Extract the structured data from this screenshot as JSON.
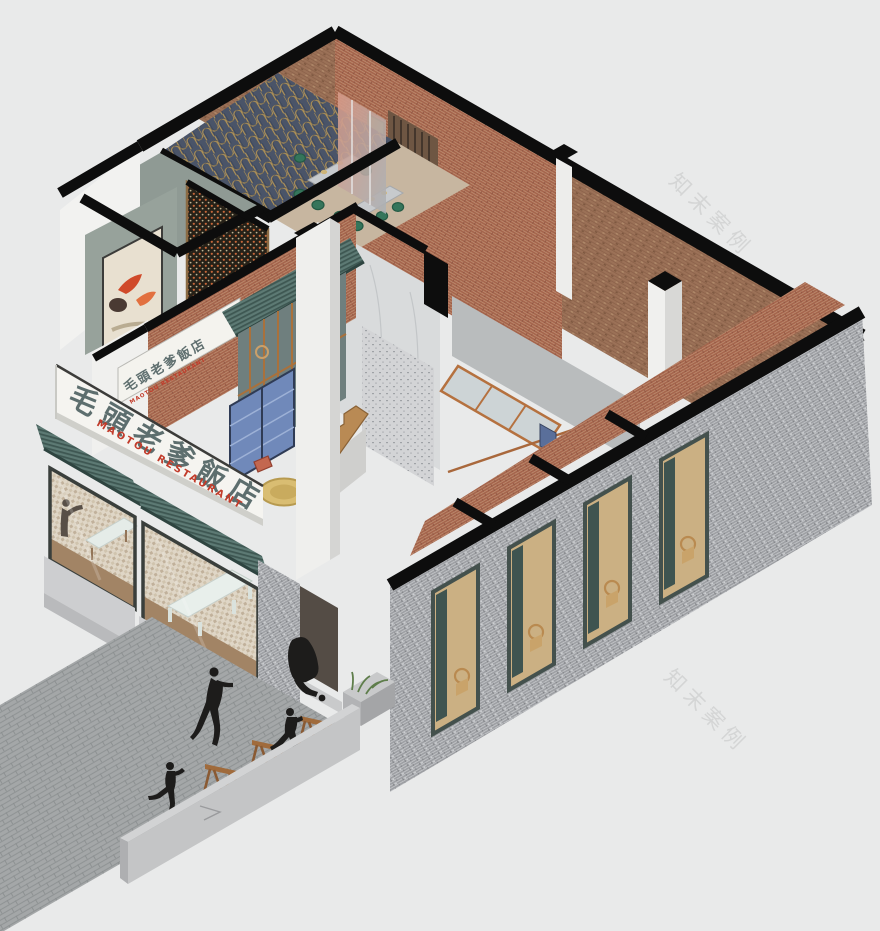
{
  "illustration": {
    "type": "isometric-cutaway-axonometric",
    "subject": "two-storey brick restaurant building with section-cut walls, interior dining rooms, street plaza and pedestrians"
  },
  "signboard": {
    "zh": "毛頭老爹飯店",
    "en": "MAOTOU RESTAURANT"
  },
  "wall_sign": {
    "zh": "毛頭老爹飯店",
    "en": "MAOTOU RESTAURANT"
  },
  "watermarks": {
    "top_right": "知末案例",
    "bottom_right": "知末案例",
    "plaza_faint": "知末案例"
  },
  "palette": {
    "background": "#e9eaea",
    "section_cut_black": "#0d0d0d",
    "red_brick": "#a5644c",
    "roof_brick": "#9b7157",
    "gray_brick": "#9d9fa3",
    "awning_green": "#5d7a74",
    "awning_green_dark": "#3e5752",
    "deco_wallpaper_navy": "#4a5468",
    "deco_wallpaper_gold": "#b29355",
    "chair_emerald": "#35755b",
    "marble_light": "#d9dbdc",
    "concrete": "#cfcfcd",
    "wood": "#b98a54",
    "cabinet_blue": "#7089ba",
    "sign_white": "#f5f4f0",
    "sign_text_green_gray": "#5d6e6e",
    "sign_text_red": "#c23b2a",
    "pavement_gray": "#a4a7a8",
    "silhouette_black": "#1d1c1b"
  },
  "figures": [
    "walking-adult-silhouette",
    "porter-carrying-sack-silhouette",
    "running-child-silhouette",
    "skipping-child-silhouette",
    "diner-shadow-behind-window"
  ],
  "props": [
    "wooden-sawhorse-bench",
    "wooden-sawhorse-bench",
    "wooden-sawhorse-bench",
    "planter-with-grass",
    "round-banquet-table",
    "tablecloth-tables",
    "bentwood-chairs",
    "emerald-dining-chairs",
    "blue-display-cabinet",
    "wood-staircase",
    "skylight-truss",
    "chimney",
    "lattice-screen",
    "leaf-artwork"
  ]
}
